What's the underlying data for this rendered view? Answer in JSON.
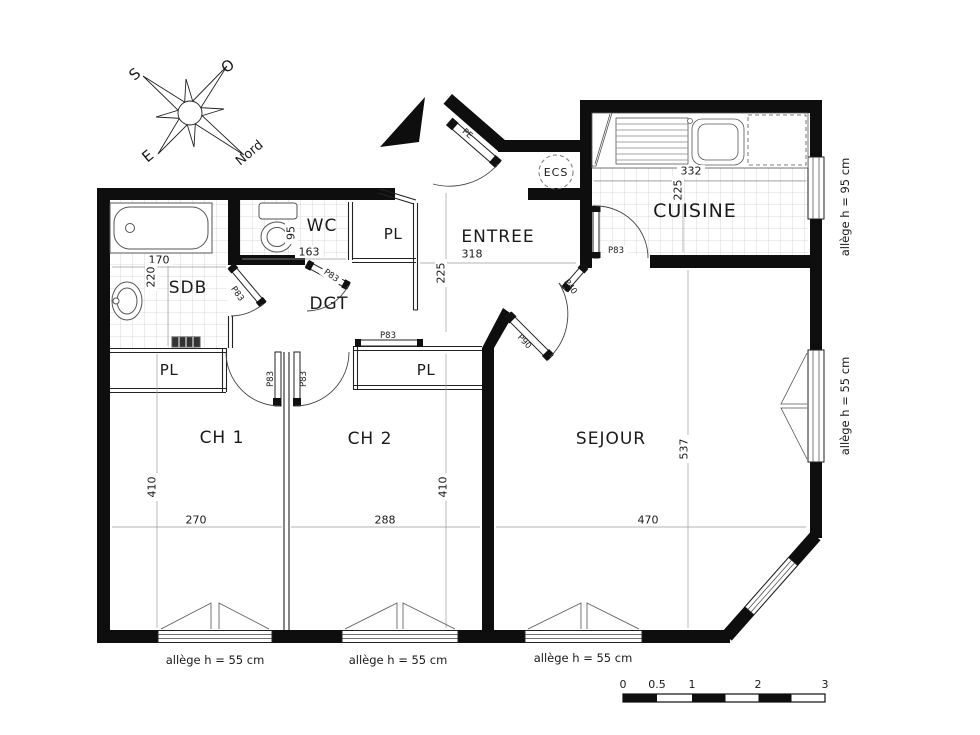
{
  "compass": {
    "north": "Nord",
    "south": "S",
    "east": "E",
    "west": "O"
  },
  "rooms": {
    "sdb": "SDB",
    "wc": "WC",
    "pl_entree": "PL",
    "entree": "ENTREE",
    "cuisine": "CUISINE",
    "ecs": "ECS",
    "dgt": "DGT",
    "pl_ch1": "PL",
    "ch1": "CH 1",
    "pl_ch2": "PL",
    "ch2": "CH 2",
    "sejour": "SEJOUR"
  },
  "dimensions": {
    "sdb_w": "170",
    "sdb_h": "220",
    "wc_w": "163",
    "wc_fixture": "95",
    "entree_w": "318",
    "entree_h": "225",
    "cuisine_w": "332",
    "cuisine_h": "225",
    "ch1_w": "270",
    "ch1_h": "410",
    "ch2_w": "288",
    "ch2_h": "410",
    "sejour_w": "470",
    "sejour_h": "537"
  },
  "doors": {
    "entrance": "PE",
    "sdb": "P83",
    "wc": "P83",
    "cuisine": "P83",
    "ch1": "P83",
    "ch2": "P83",
    "ch2_closet": "P83",
    "sejour_main": "P90",
    "sejour_secondary": "P40"
  },
  "windows": {
    "cuisine": "allège h = 95 cm",
    "sejour_side": "allège h = 55 cm",
    "ch1": "allège h = 55 cm",
    "ch2": "allège h = 55 cm",
    "sejour_bottom": "allège h = 55 cm"
  },
  "scalebar": {
    "ticks": [
      "0",
      "0.5",
      "1",
      "2",
      "3"
    ]
  }
}
